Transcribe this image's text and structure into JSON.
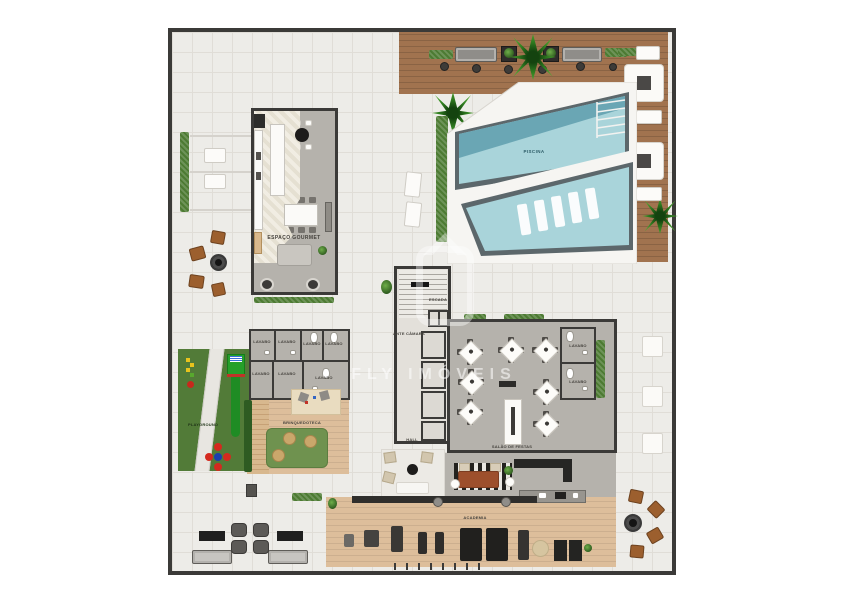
{
  "watermark": {
    "brand": "FLY IMÓVEIS"
  },
  "labels": {
    "piscina": "PISCINA",
    "espaco_gourmet": "ESPAÇO GOURMET",
    "escada": "ESCADA",
    "ante_camara": "ANTE CÂMARA",
    "lavabo": "LAVABO",
    "brinquedoteca": "BRINQUEDOTECA",
    "playground": "PLAYGROUND",
    "salao_de_festas": "SALÃO DE FESTAS",
    "hall": "HALL",
    "academia": "ACADEMIA"
  },
  "colors": {
    "wall": "#3b3a38",
    "tile": "#edece8",
    "tile_line": "#e0ddd7",
    "deck_wood": "#a1734f",
    "pool_water": "#a9d4da",
    "pool_deep": "#6aa6b4",
    "pool_rim": "#5c676b",
    "floor_gray": "#b5b2ac",
    "lawn": "#527b38",
    "hedge": "#4d7b33",
    "gym_wood": "#ddbe9b",
    "seat_wood": "#9c5f2e"
  }
}
